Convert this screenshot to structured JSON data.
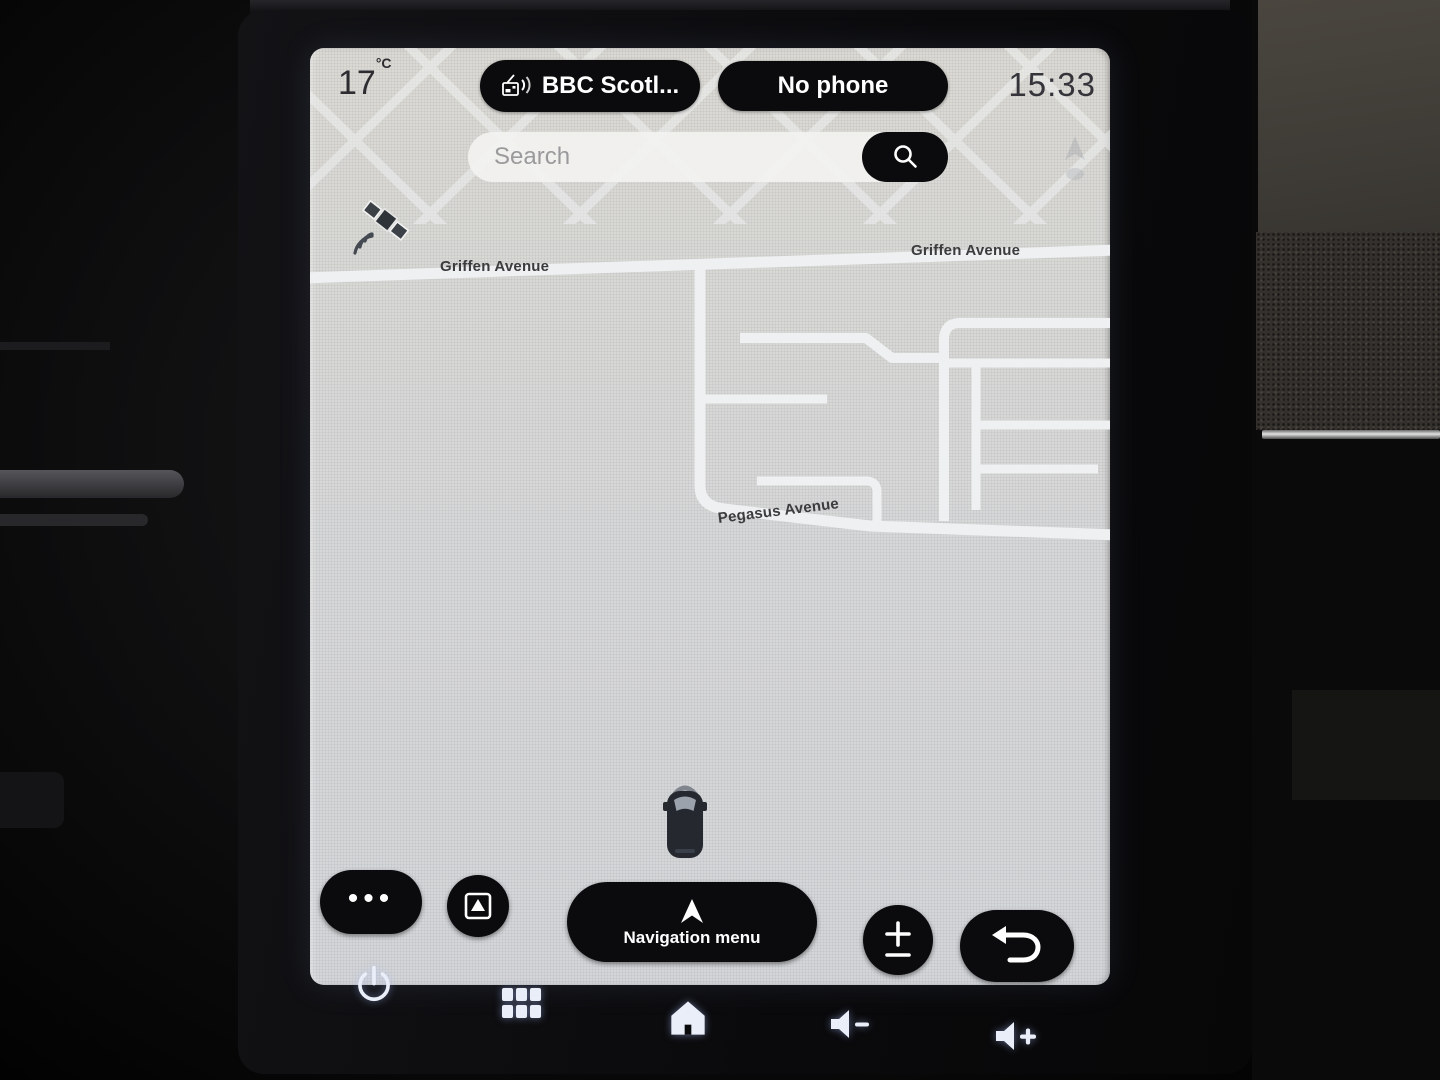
{
  "status_bar": {
    "temperature": "17",
    "temperature_unit": "°C",
    "radio_station": "BBC Scotl...",
    "phone_status": "No phone",
    "clock": "15:33"
  },
  "search": {
    "placeholder": "Search"
  },
  "map": {
    "labels": {
      "griffen_left": "Griffen Avenue",
      "griffen_right": "Griffen Avenue",
      "pegasus": "Pegasus Avenue"
    }
  },
  "controls": {
    "more_options_glyph": "•••",
    "navigation_menu_label": "Navigation menu"
  },
  "icons": {
    "radio": "dab-radio-icon",
    "search": "magnifier-icon",
    "gps_status": "satellite-icon",
    "vehicle_position": "car-top-view-icon",
    "map_view_toggle": "square-with-up-triangle",
    "navigation_menu": "up-arrow-cursor",
    "zoom": "plus-minus-icon",
    "back": "return-arrow-icon",
    "power": "power-symbol",
    "apps": "six-square-grid",
    "home": "house-icon",
    "volume_down": "speaker-minus",
    "volume_up": "speaker-plus"
  },
  "theme": {
    "pill_bg": "#0b0b0d",
    "pill_text": "#ffffff",
    "map_bg": "#d8d8d5",
    "road_color": "#eef0f1",
    "map_label_color": "#3c3c3f",
    "status_text_color": "#34343a",
    "hardware_icon_color": "#e9eef9"
  }
}
